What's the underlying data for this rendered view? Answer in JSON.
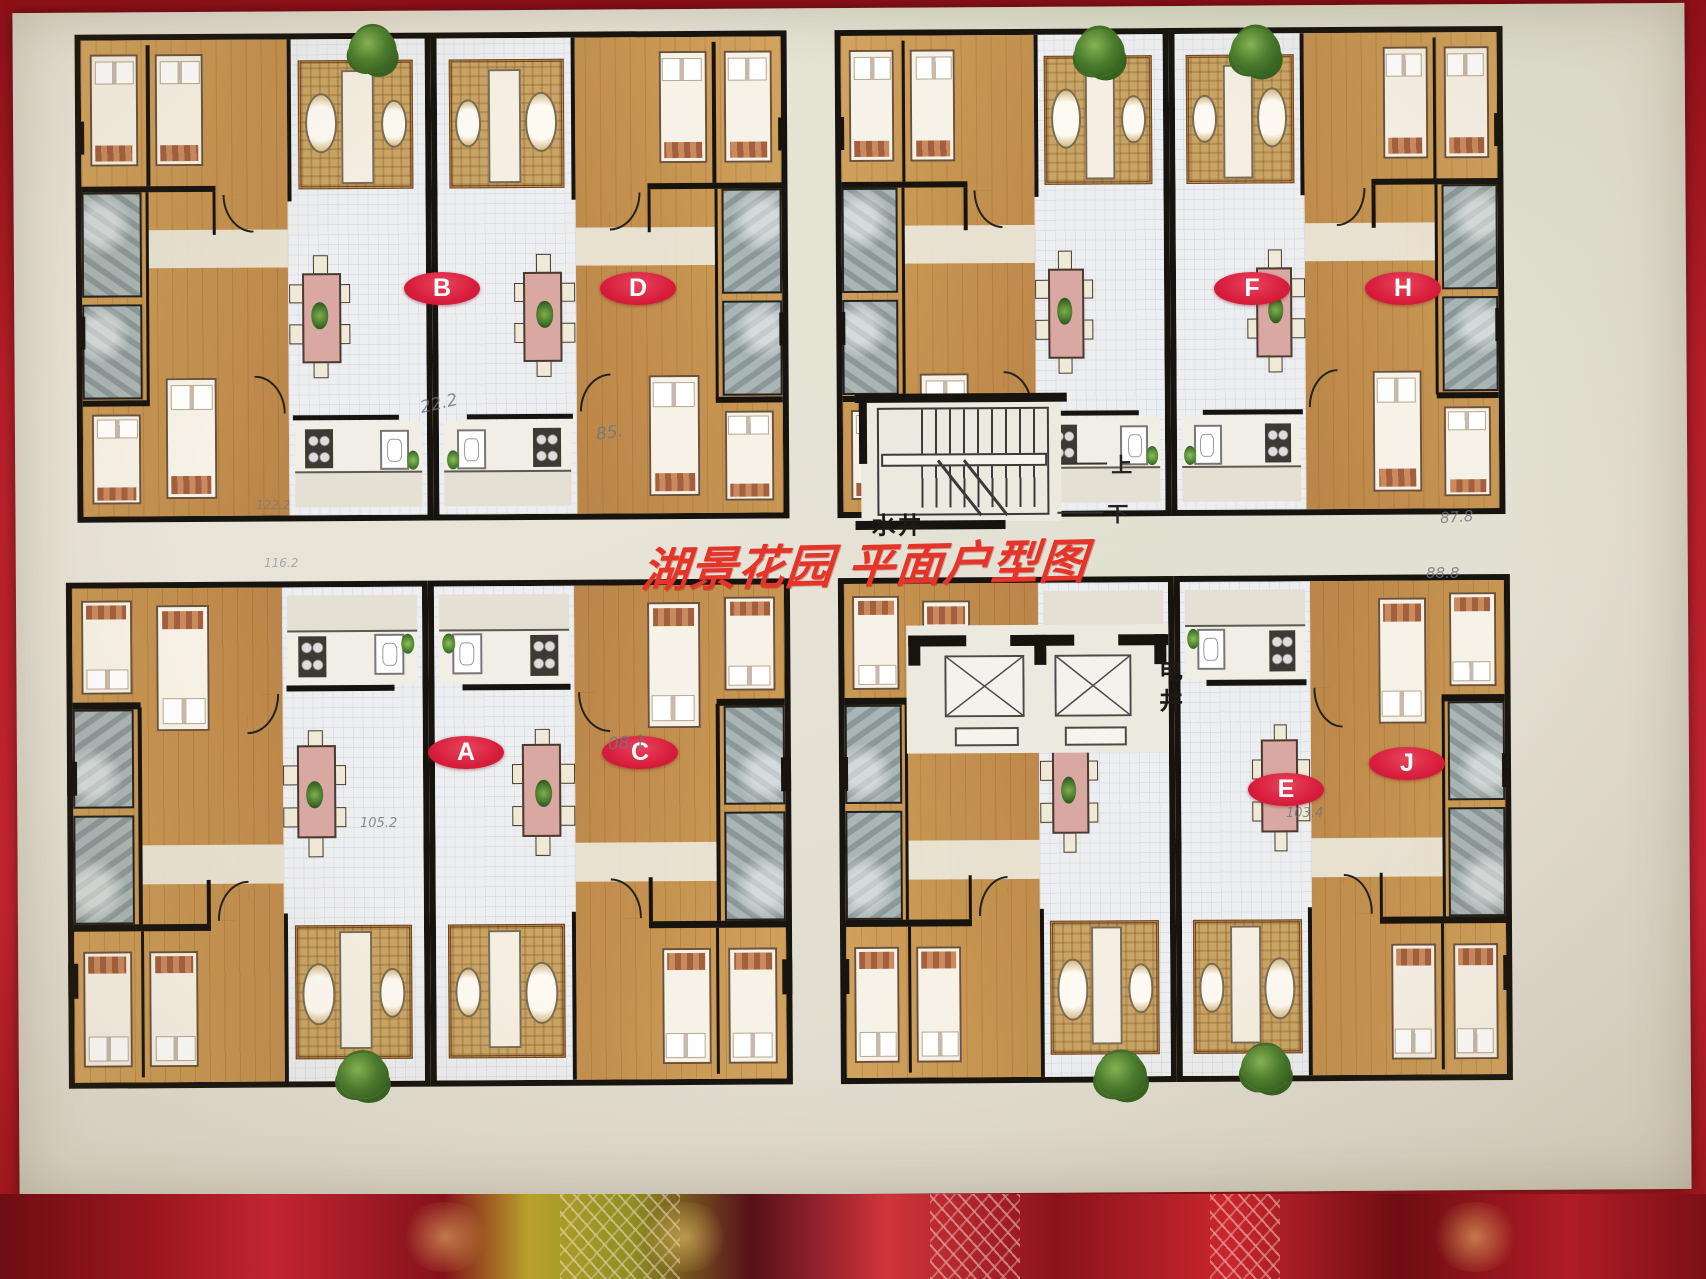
{
  "poster": {
    "title": "湖景花园 平面户型图"
  },
  "unit_labels": {
    "A": "A",
    "B": "B",
    "C": "C",
    "D": "D",
    "E": "E",
    "F": "F",
    "H": "H",
    "J": "J"
  },
  "core_labels": {
    "water_shaft": "水井",
    "electric_shaft": "电井",
    "stairs_up": "上",
    "stairs_down": "下"
  },
  "handwritten_notes": {
    "b_dining": "22.2",
    "d_dining": "85.",
    "c_dining": "08.1",
    "a_area": "105.2",
    "e_area": "103.4",
    "h_area_1": "87.8",
    "h_area_2": "88.8",
    "tl_margin_1": "122.2",
    "tl_margin_2": "116.2"
  },
  "colors": {
    "title_red": "#e5342a",
    "badge_red": "#d81e3c",
    "wood_floor": "#c89a55",
    "bath_tile": "#a9b2b1",
    "poster_bg": "#e9e5da",
    "frame_red": "#b51f28"
  }
}
